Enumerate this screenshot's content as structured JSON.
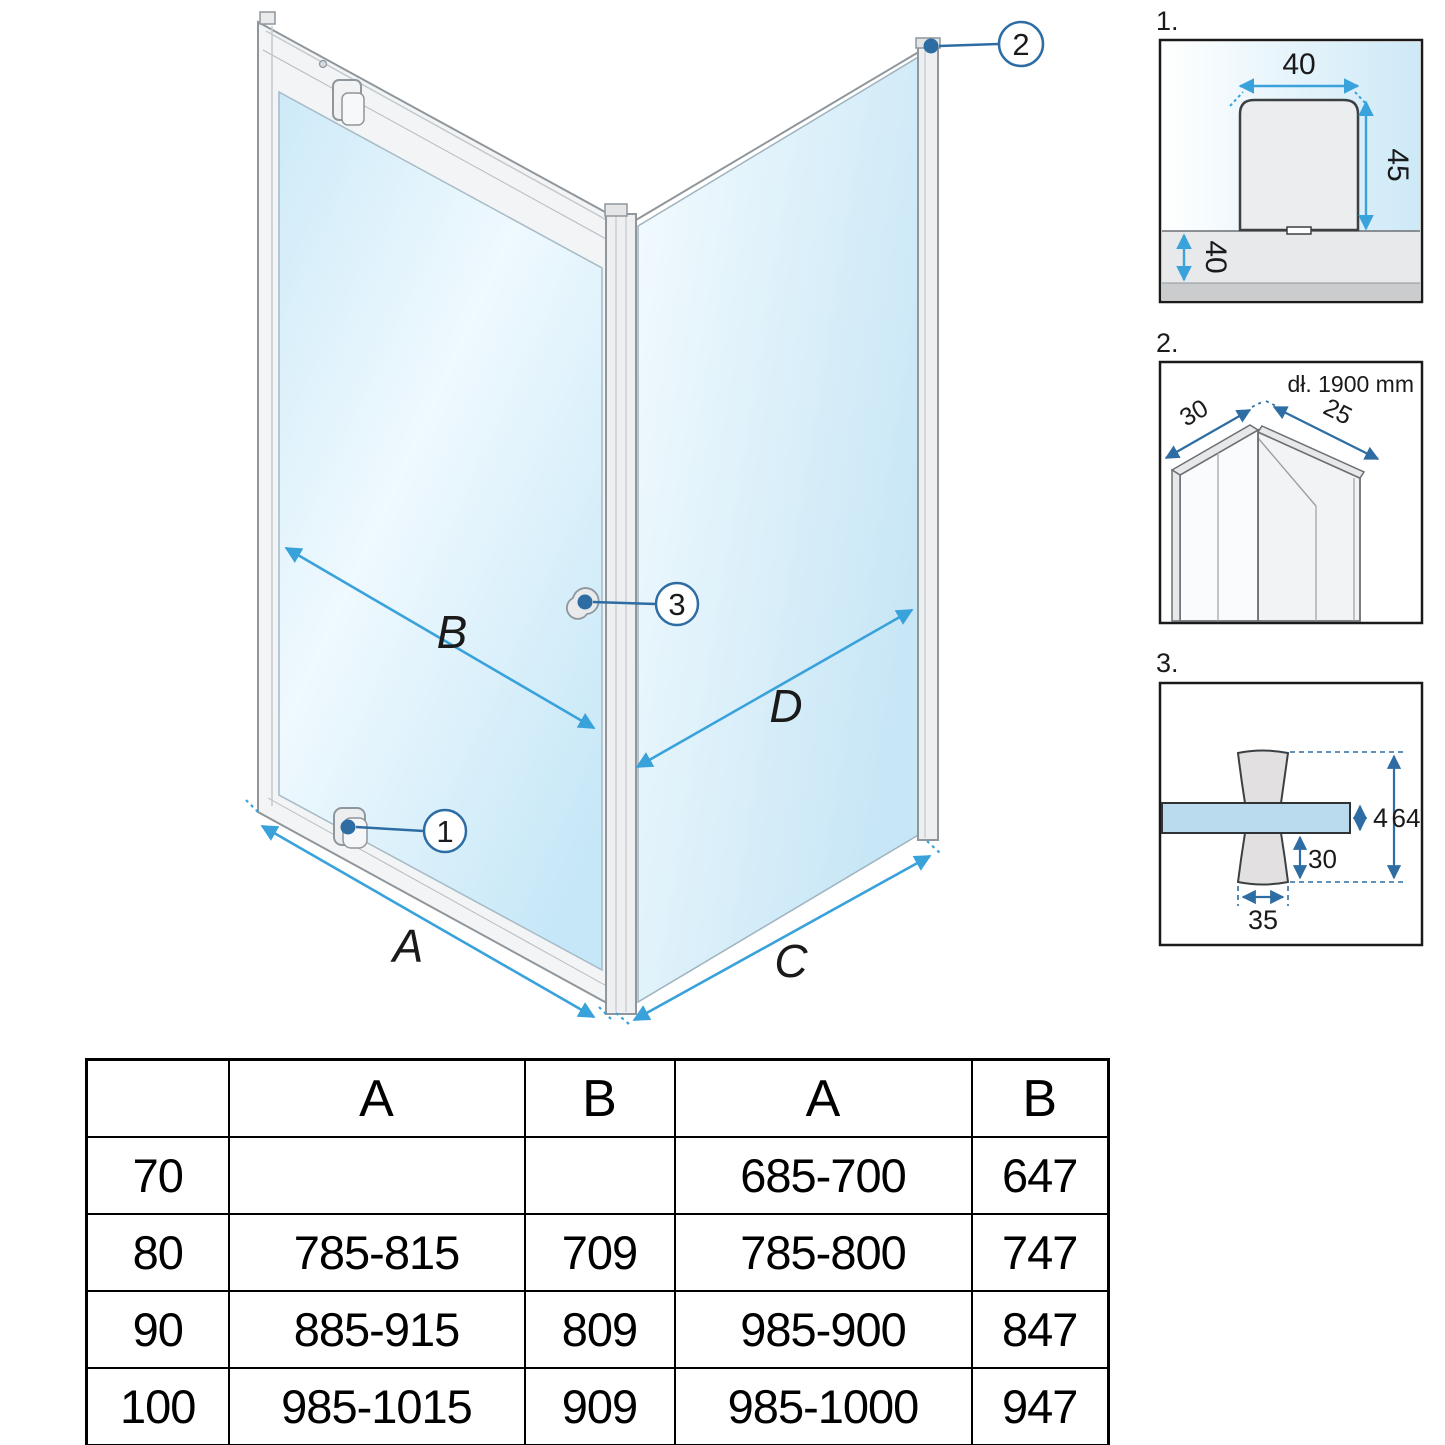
{
  "diagram": {
    "dimension_labels": {
      "a": "A",
      "b": "B",
      "c": "C",
      "d": "D"
    },
    "callouts": {
      "one": "1",
      "two": "2",
      "three": "3"
    }
  },
  "details": {
    "d1": {
      "label": "1.",
      "top_mm": "40",
      "side_mm": "45",
      "tray_mm": "40"
    },
    "d2": {
      "label": "2.",
      "length_note": "dł. 1900 mm",
      "left_mm": "30",
      "right_mm": "25"
    },
    "d3": {
      "label": "3.",
      "glass_mm": "4",
      "total_mm": "64",
      "lower_mm": "30",
      "knob_mm": "35"
    }
  },
  "table": {
    "headers": [
      "",
      "A",
      "B",
      "A",
      "B"
    ],
    "rows": [
      [
        "70",
        "",
        "",
        "685-700",
        "647"
      ],
      [
        "80",
        "785-815",
        "709",
        "785-800",
        "747"
      ],
      [
        "90",
        "885-915",
        "809",
        "985-900",
        "847"
      ],
      [
        "100",
        "985-1015",
        "909",
        "985-1000",
        "947"
      ]
    ]
  },
  "colors": {
    "dimension_arrow": "#3aa2db",
    "callout_blue": "#2e6da4",
    "glass_tint": "#c9e8f7",
    "profile_grey": "#edeff1"
  }
}
